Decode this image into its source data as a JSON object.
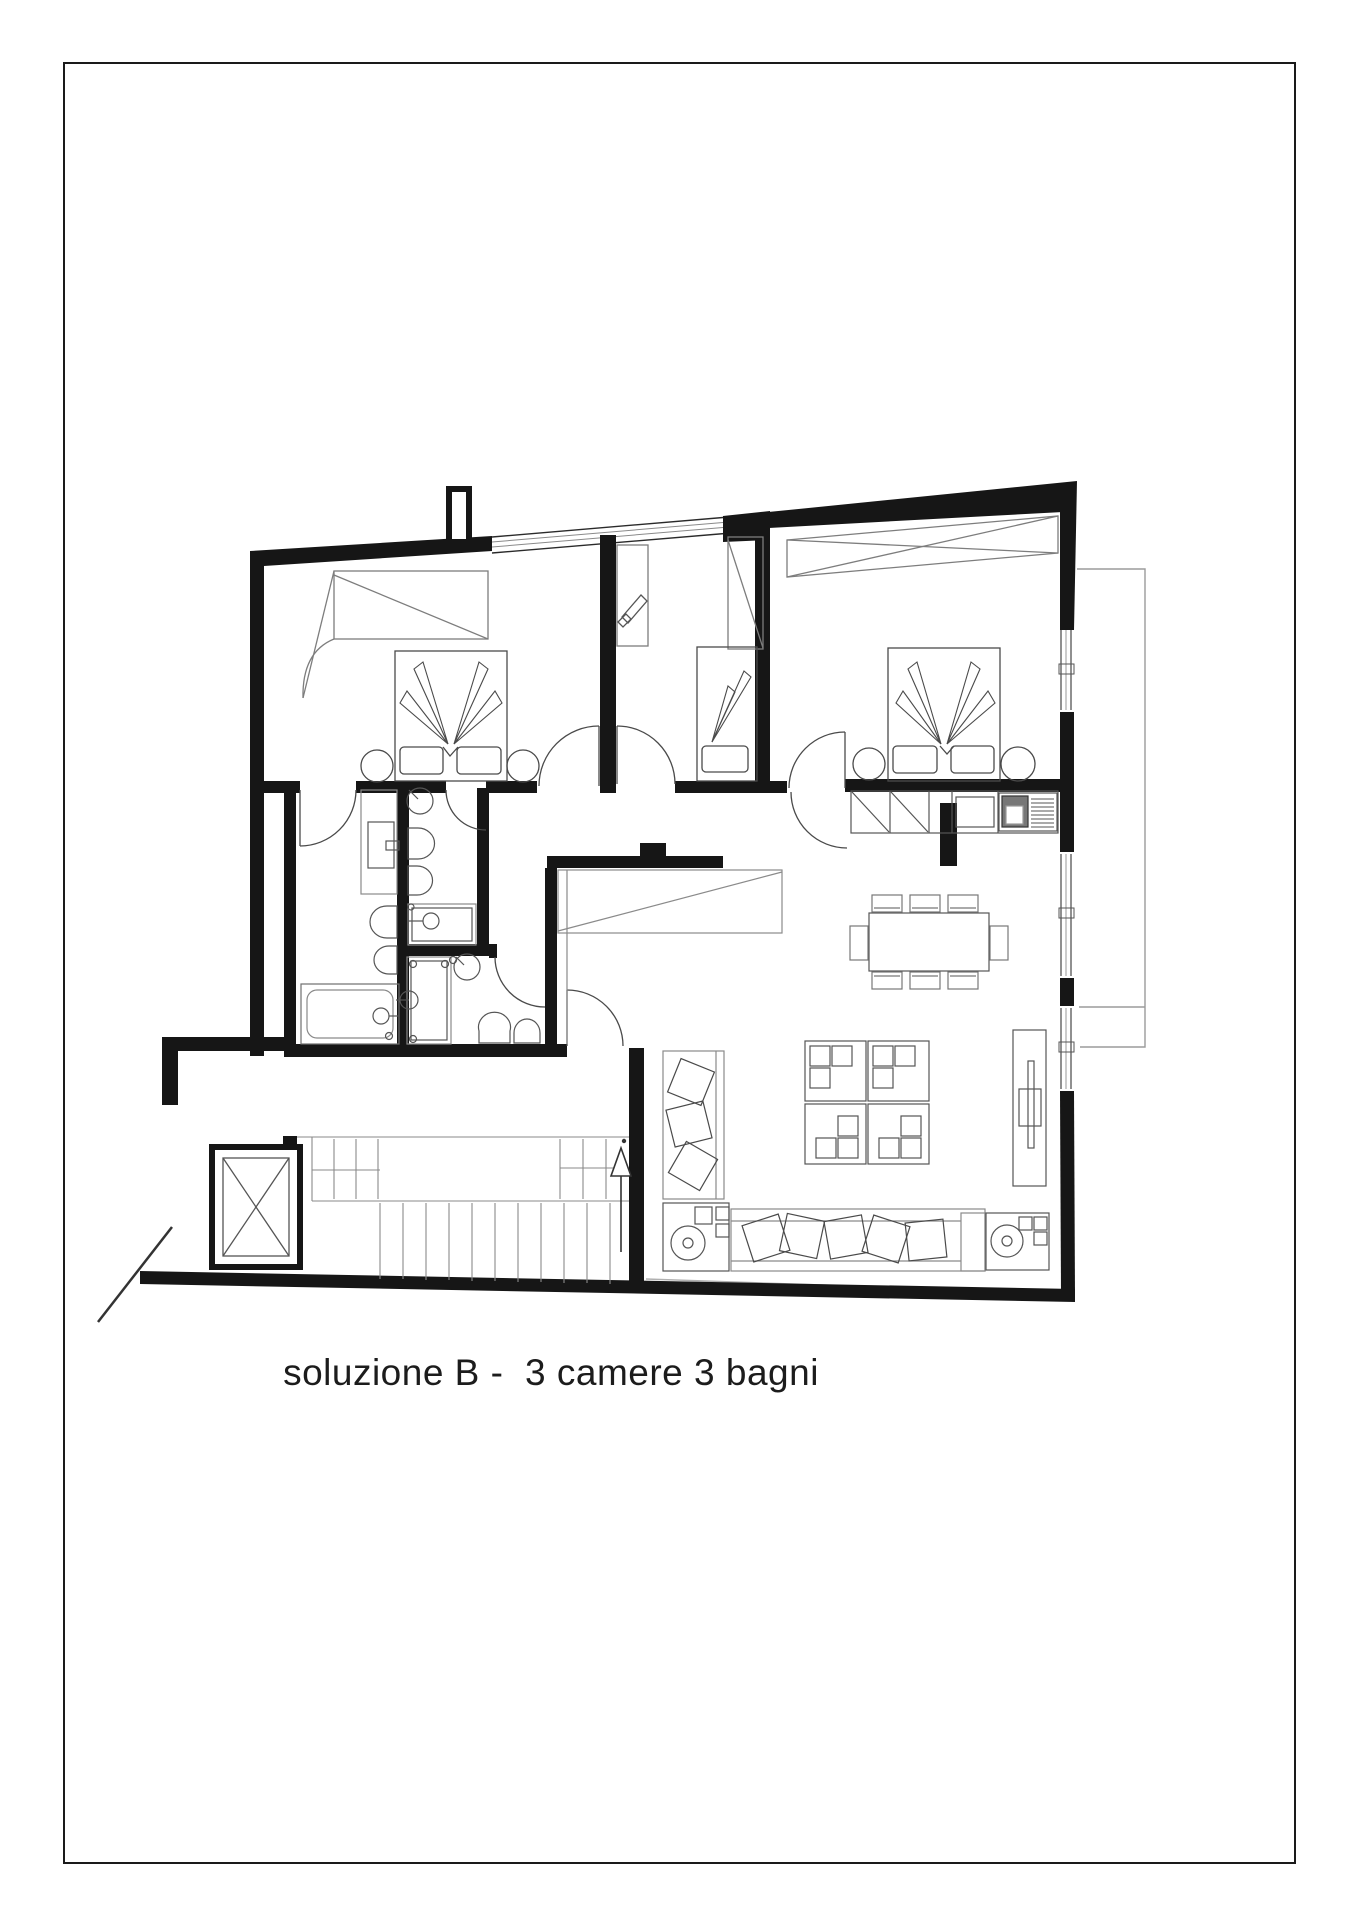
{
  "title": {
    "text": "soluzione B -  3 camere 3 bagni",
    "solution_label": "B",
    "bedrooms_count": 3,
    "bathrooms_count": 3
  },
  "page": {
    "background": "#ffffff",
    "frame_color": "#1a1a1a"
  },
  "plan": {
    "ink_color": "#161616",
    "furniture_color": "#4a4a4a",
    "fixture_color": "#6f6f6f",
    "light_line_color": "#8a8a8a",
    "construction_line_color": "#9b9b9b",
    "elements": [
      "exterior-walls",
      "interior-walls",
      "window-band",
      "right-wall-windows",
      "terrace-outline",
      "chimney-stub",
      "bedroom-1",
      "bedroom-2",
      "bedroom-3",
      "double-bed",
      "single-bed",
      "nightstands",
      "wardrobes",
      "desk",
      "bathroom-1",
      "bathroom-2",
      "bathroom-3",
      "vanity",
      "toilet",
      "bidet",
      "bathtub",
      "shower-tray",
      "corner-sink",
      "hall-closet",
      "kitchen-counter",
      "sink",
      "cooktop",
      "dining-table",
      "dining-chairs",
      "armchairs",
      "tv-panel",
      "sofa",
      "cushions",
      "speaker-units",
      "chaise-longue",
      "entrance-door",
      "door-swings",
      "staircase",
      "stair-direction-arrow",
      "elevator",
      "section-break-line"
    ]
  }
}
